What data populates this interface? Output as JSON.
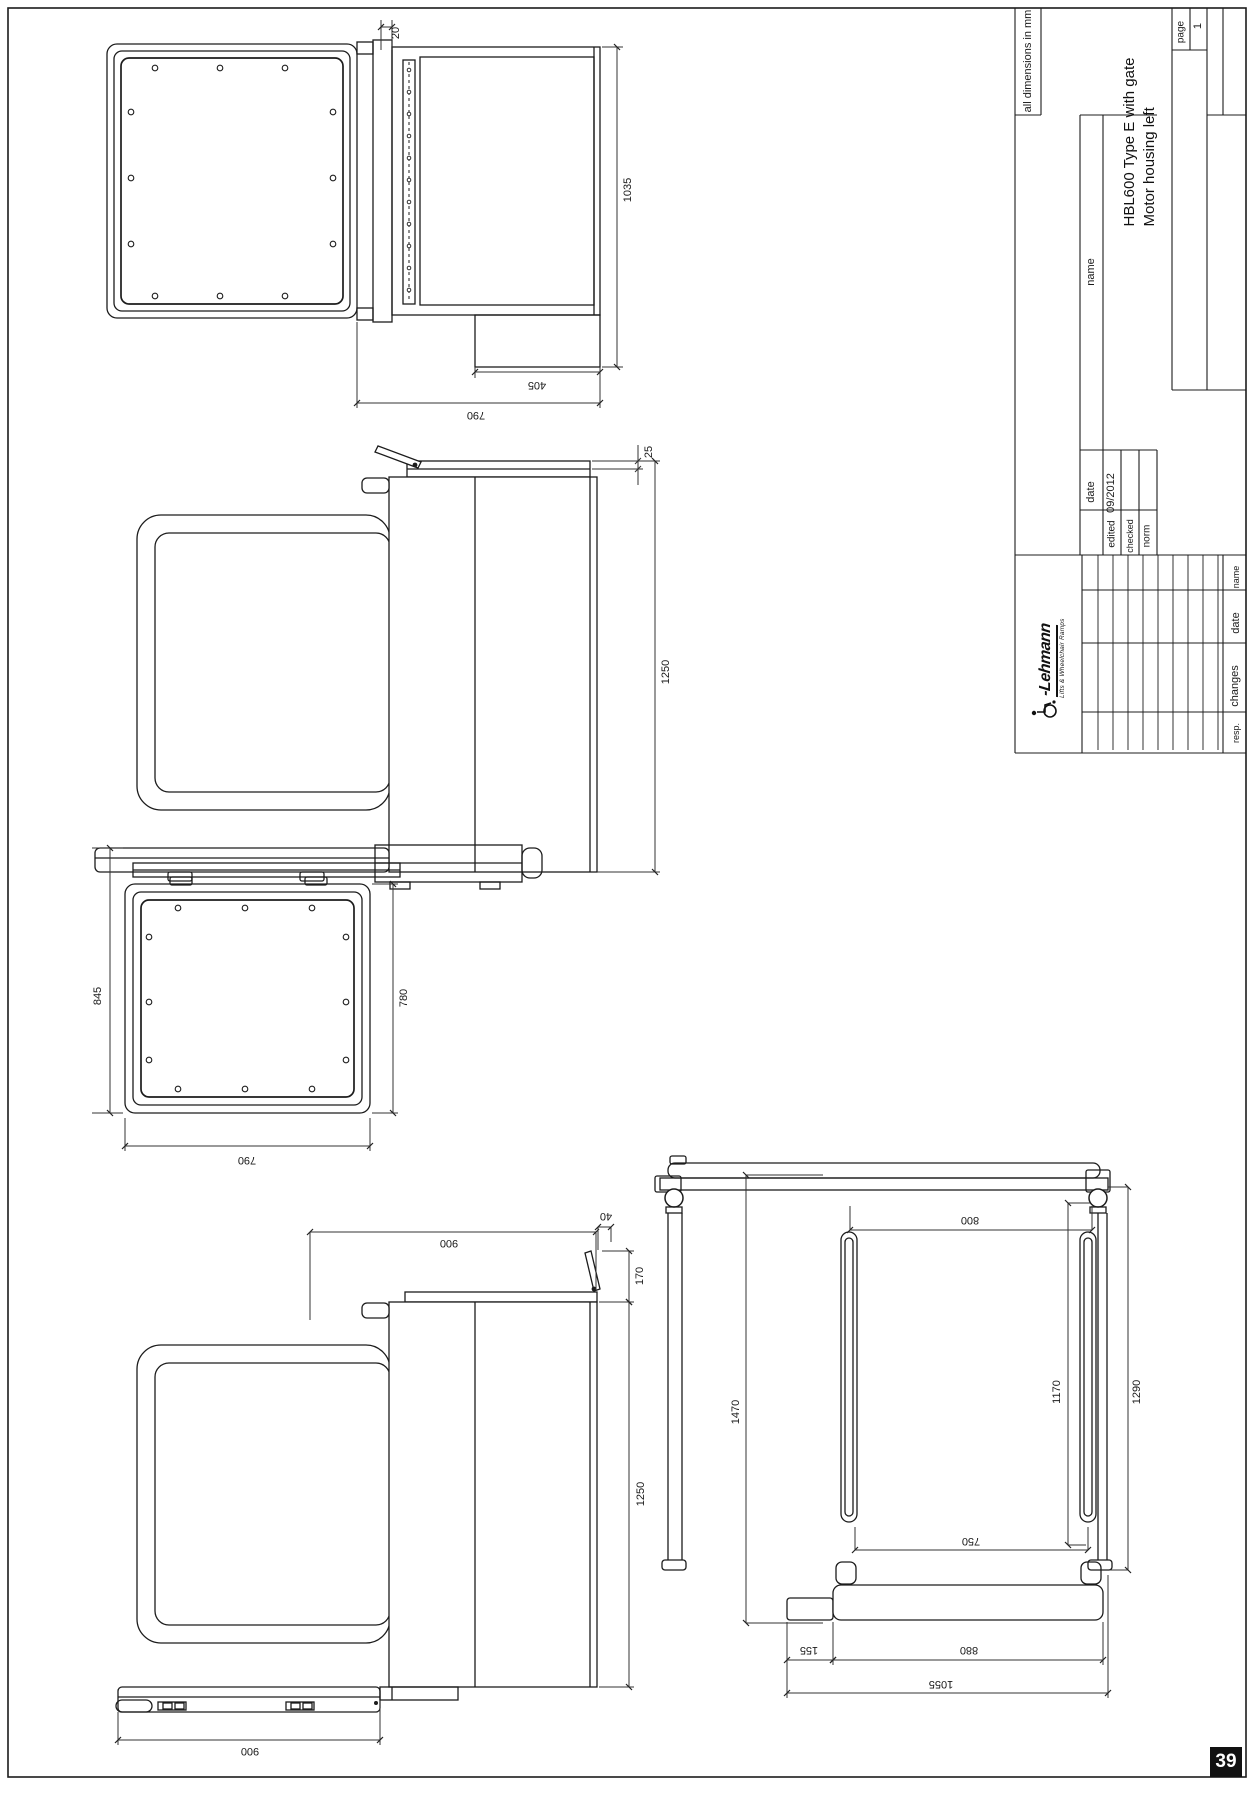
{
  "page": {
    "number": "39"
  },
  "title_block": {
    "units_note": "all dimensions in mm",
    "title_line1": "HBL600 Type E with gate",
    "title_line2": "Motor housing left",
    "page_label": "page",
    "page_value": "1",
    "approval": {
      "date_header": "date",
      "name_header": "name",
      "edited_label": "edited",
      "edited_date": "09/2012",
      "checked_label": "checked",
      "norm_label": "norm"
    },
    "revision_headers": {
      "resp": "resp.",
      "changes": "changes",
      "date": "date",
      "name": "name"
    },
    "logo": {
      "brand": "-Lehmann",
      "tagline": "Lifts & Wheelchair Ramps"
    }
  },
  "dimensions": {
    "top_view": {
      "gap": "20",
      "height": "1035",
      "motor": "405",
      "width": "790"
    },
    "side_raised": {
      "cap": "25",
      "mast": "1250"
    },
    "plan": {
      "left": "845",
      "right": "780",
      "bottom": "790"
    },
    "side_lowered": {
      "top": "900",
      "lever": "40",
      "cap": "170",
      "mast": "1250",
      "platform": "900"
    },
    "front": {
      "total": "1470",
      "rail": "800",
      "guide": "1170",
      "mast": "1290",
      "inner": "750",
      "offset": "155",
      "base": "880",
      "overall": "1055"
    }
  }
}
